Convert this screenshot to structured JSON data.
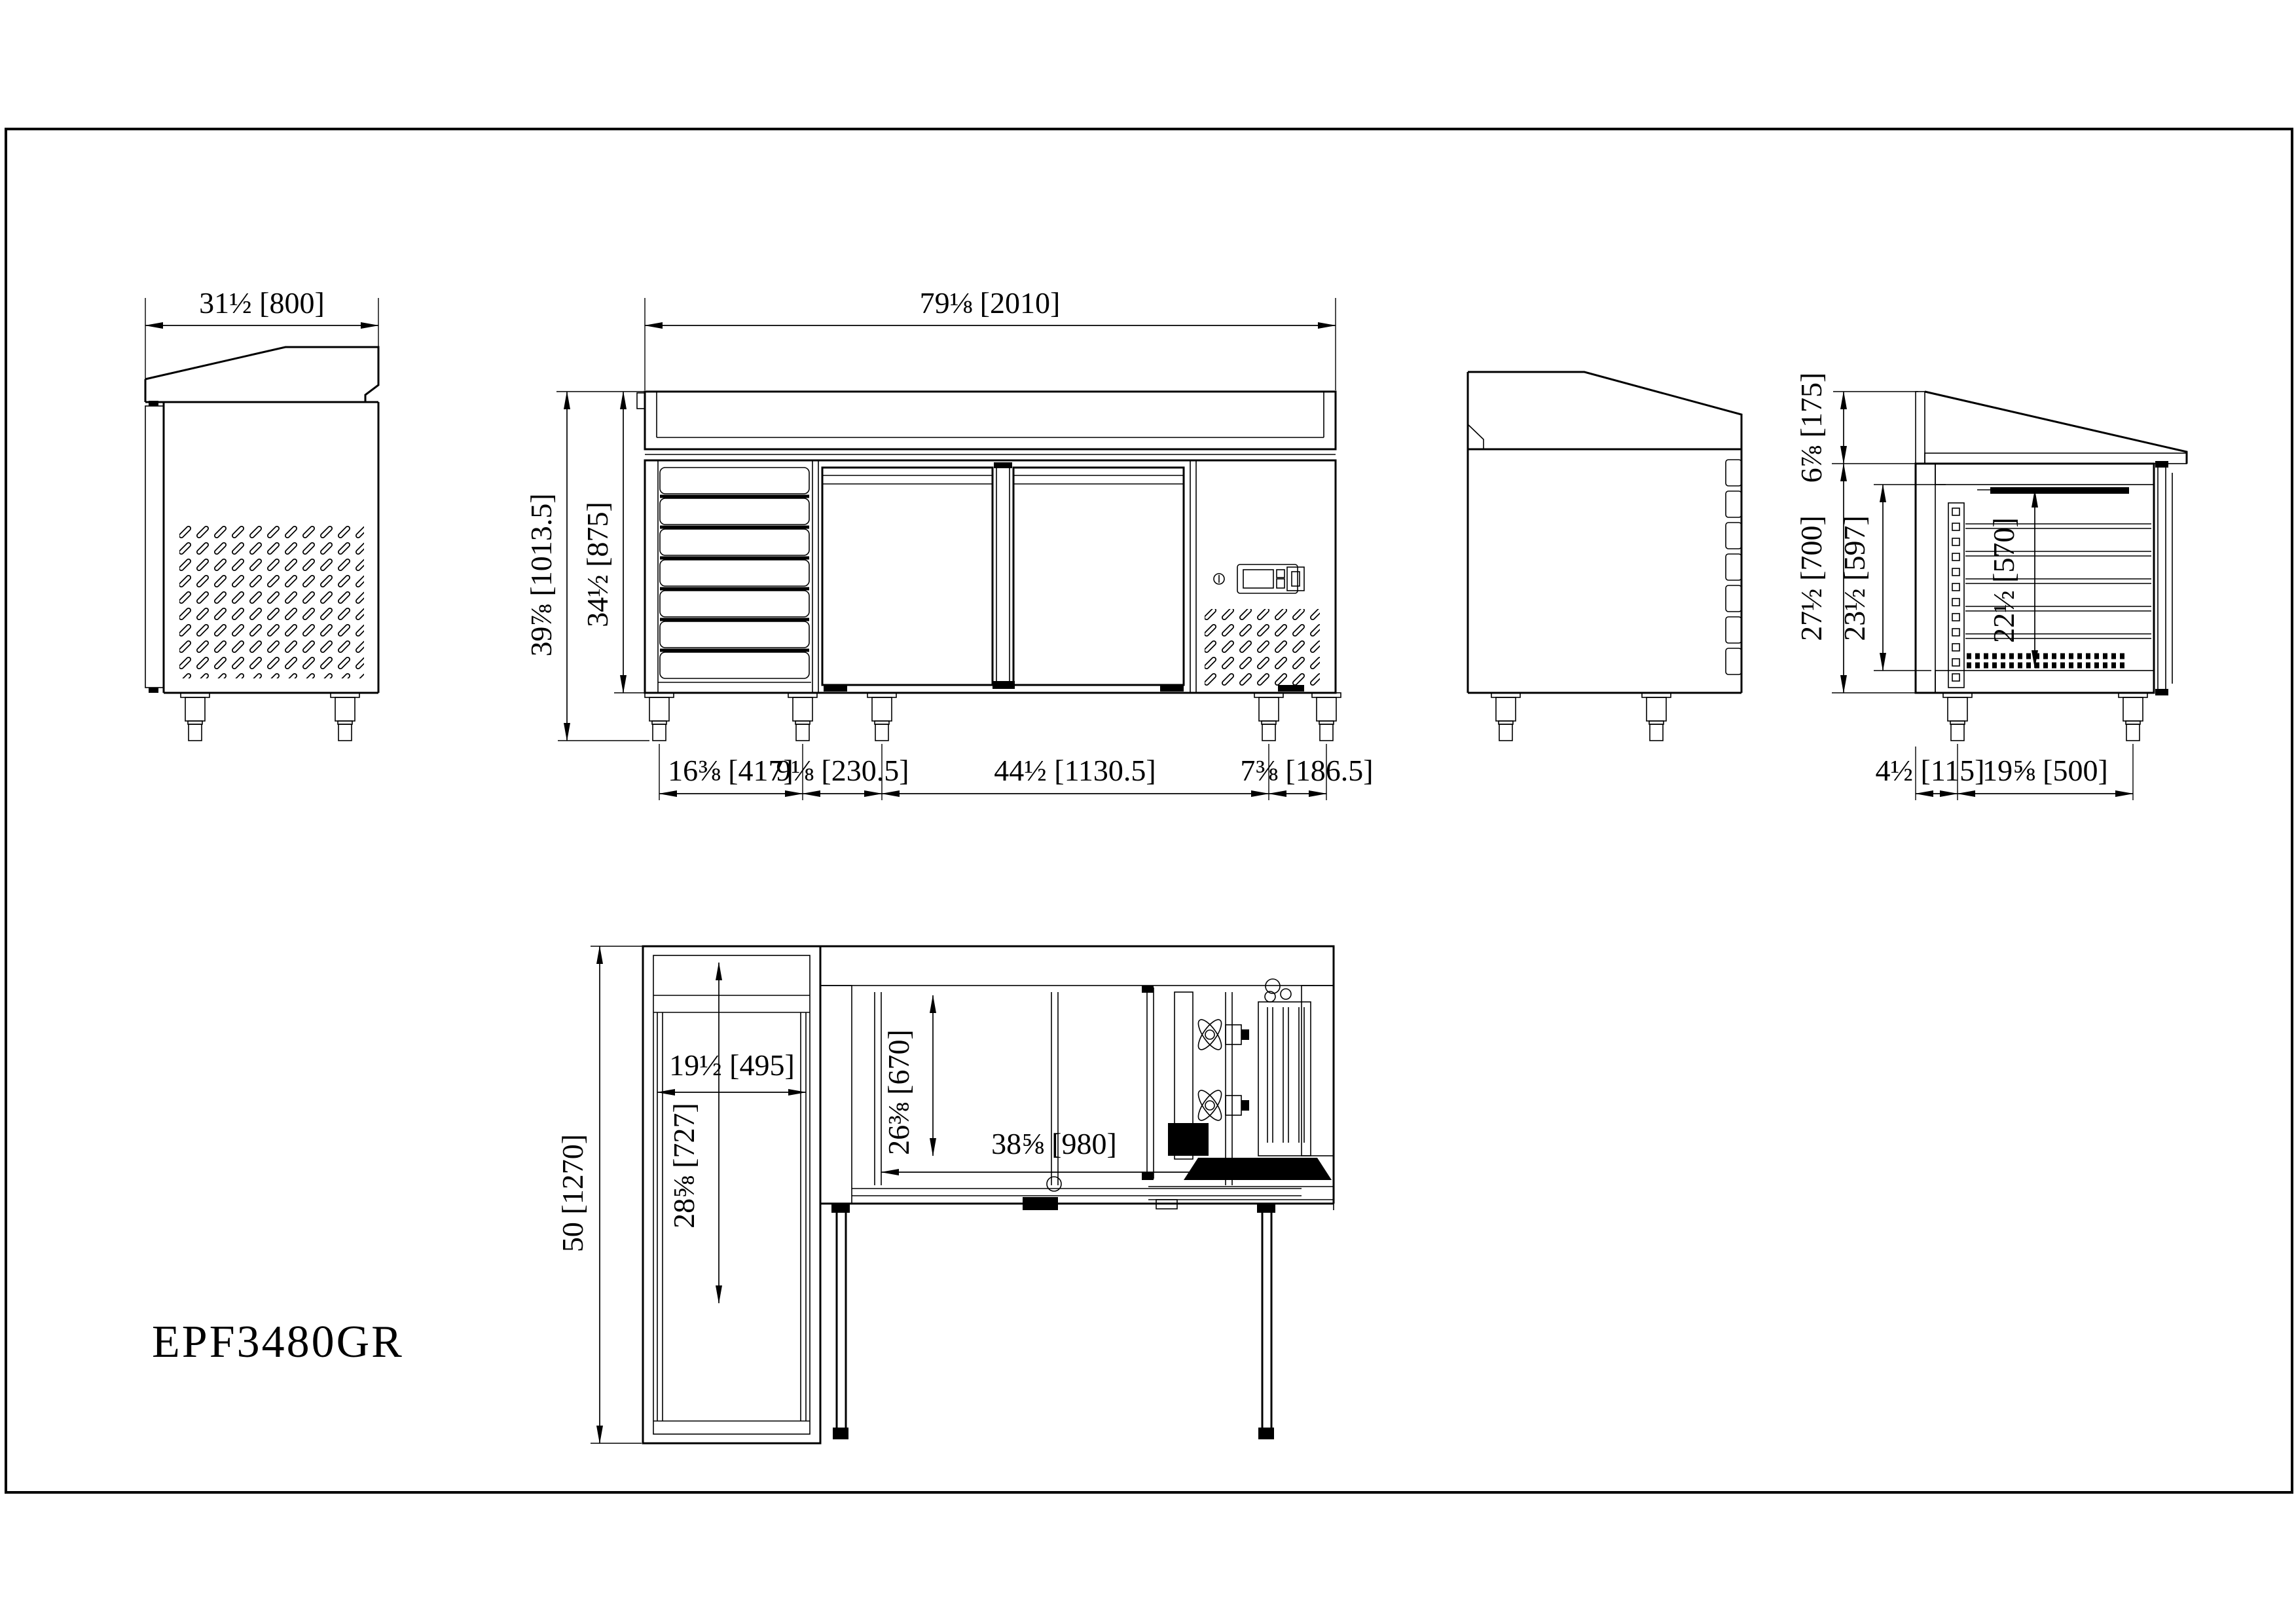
{
  "title": {
    "text": "EPF3480GR"
  },
  "dims": {
    "v1_w": "31½ [800]",
    "front_w": "79⅛ [2010]",
    "front_h1": "39⅞ [1013.5]",
    "front_h2": "34½ [875]",
    "front_b1": "16⅜ [417]",
    "front_b2": "9⅛ [230.5]",
    "front_b3": "44½ [1130.5]",
    "front_b4": "7⅜ [186.5]",
    "sec_top": "6⅞ [175]",
    "sec_h1": "27½ [700]",
    "sec_h2": "23½ [597]",
    "sec_h3": "22½ [570]",
    "sec_b1": "4½ [115]",
    "sec_b2": "19⅝ [500]",
    "plan_d": "50 [1270]",
    "plan_b1": "19½ [495]",
    "plan_b2": "28⅝ [727]",
    "plan_b3": "26⅜ [670]",
    "plan_b4": "38⅝ [980]"
  }
}
